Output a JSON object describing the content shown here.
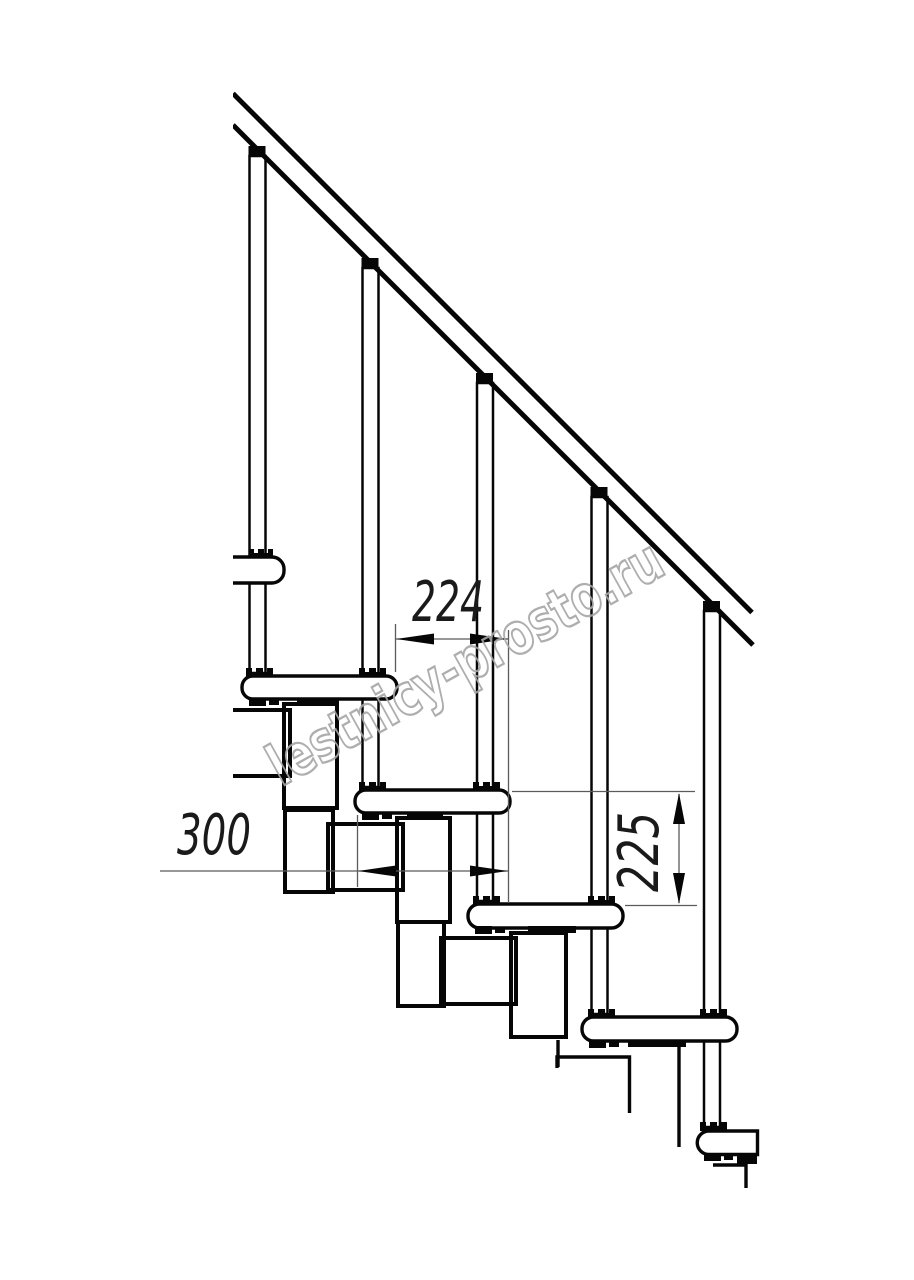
{
  "page": {
    "background": "#ffffff"
  },
  "drawing": {
    "kind": "modular staircase side-view technical drawing",
    "line_color": "#060606",
    "counts": {
      "balusters": 5,
      "treads_visible": 6,
      "handrail_segments": 1
    },
    "watermark": {
      "text": "lestnicy-prosto.ru",
      "color": "#a6a6a6"
    },
    "dimensions": [
      {
        "id": "step-pitch",
        "label": "224",
        "orientation": "horizontal"
      },
      {
        "id": "tread-depth",
        "label": "300",
        "orientation": "horizontal"
      },
      {
        "id": "riser-height",
        "label": "225",
        "orientation": "vertical"
      }
    ]
  }
}
